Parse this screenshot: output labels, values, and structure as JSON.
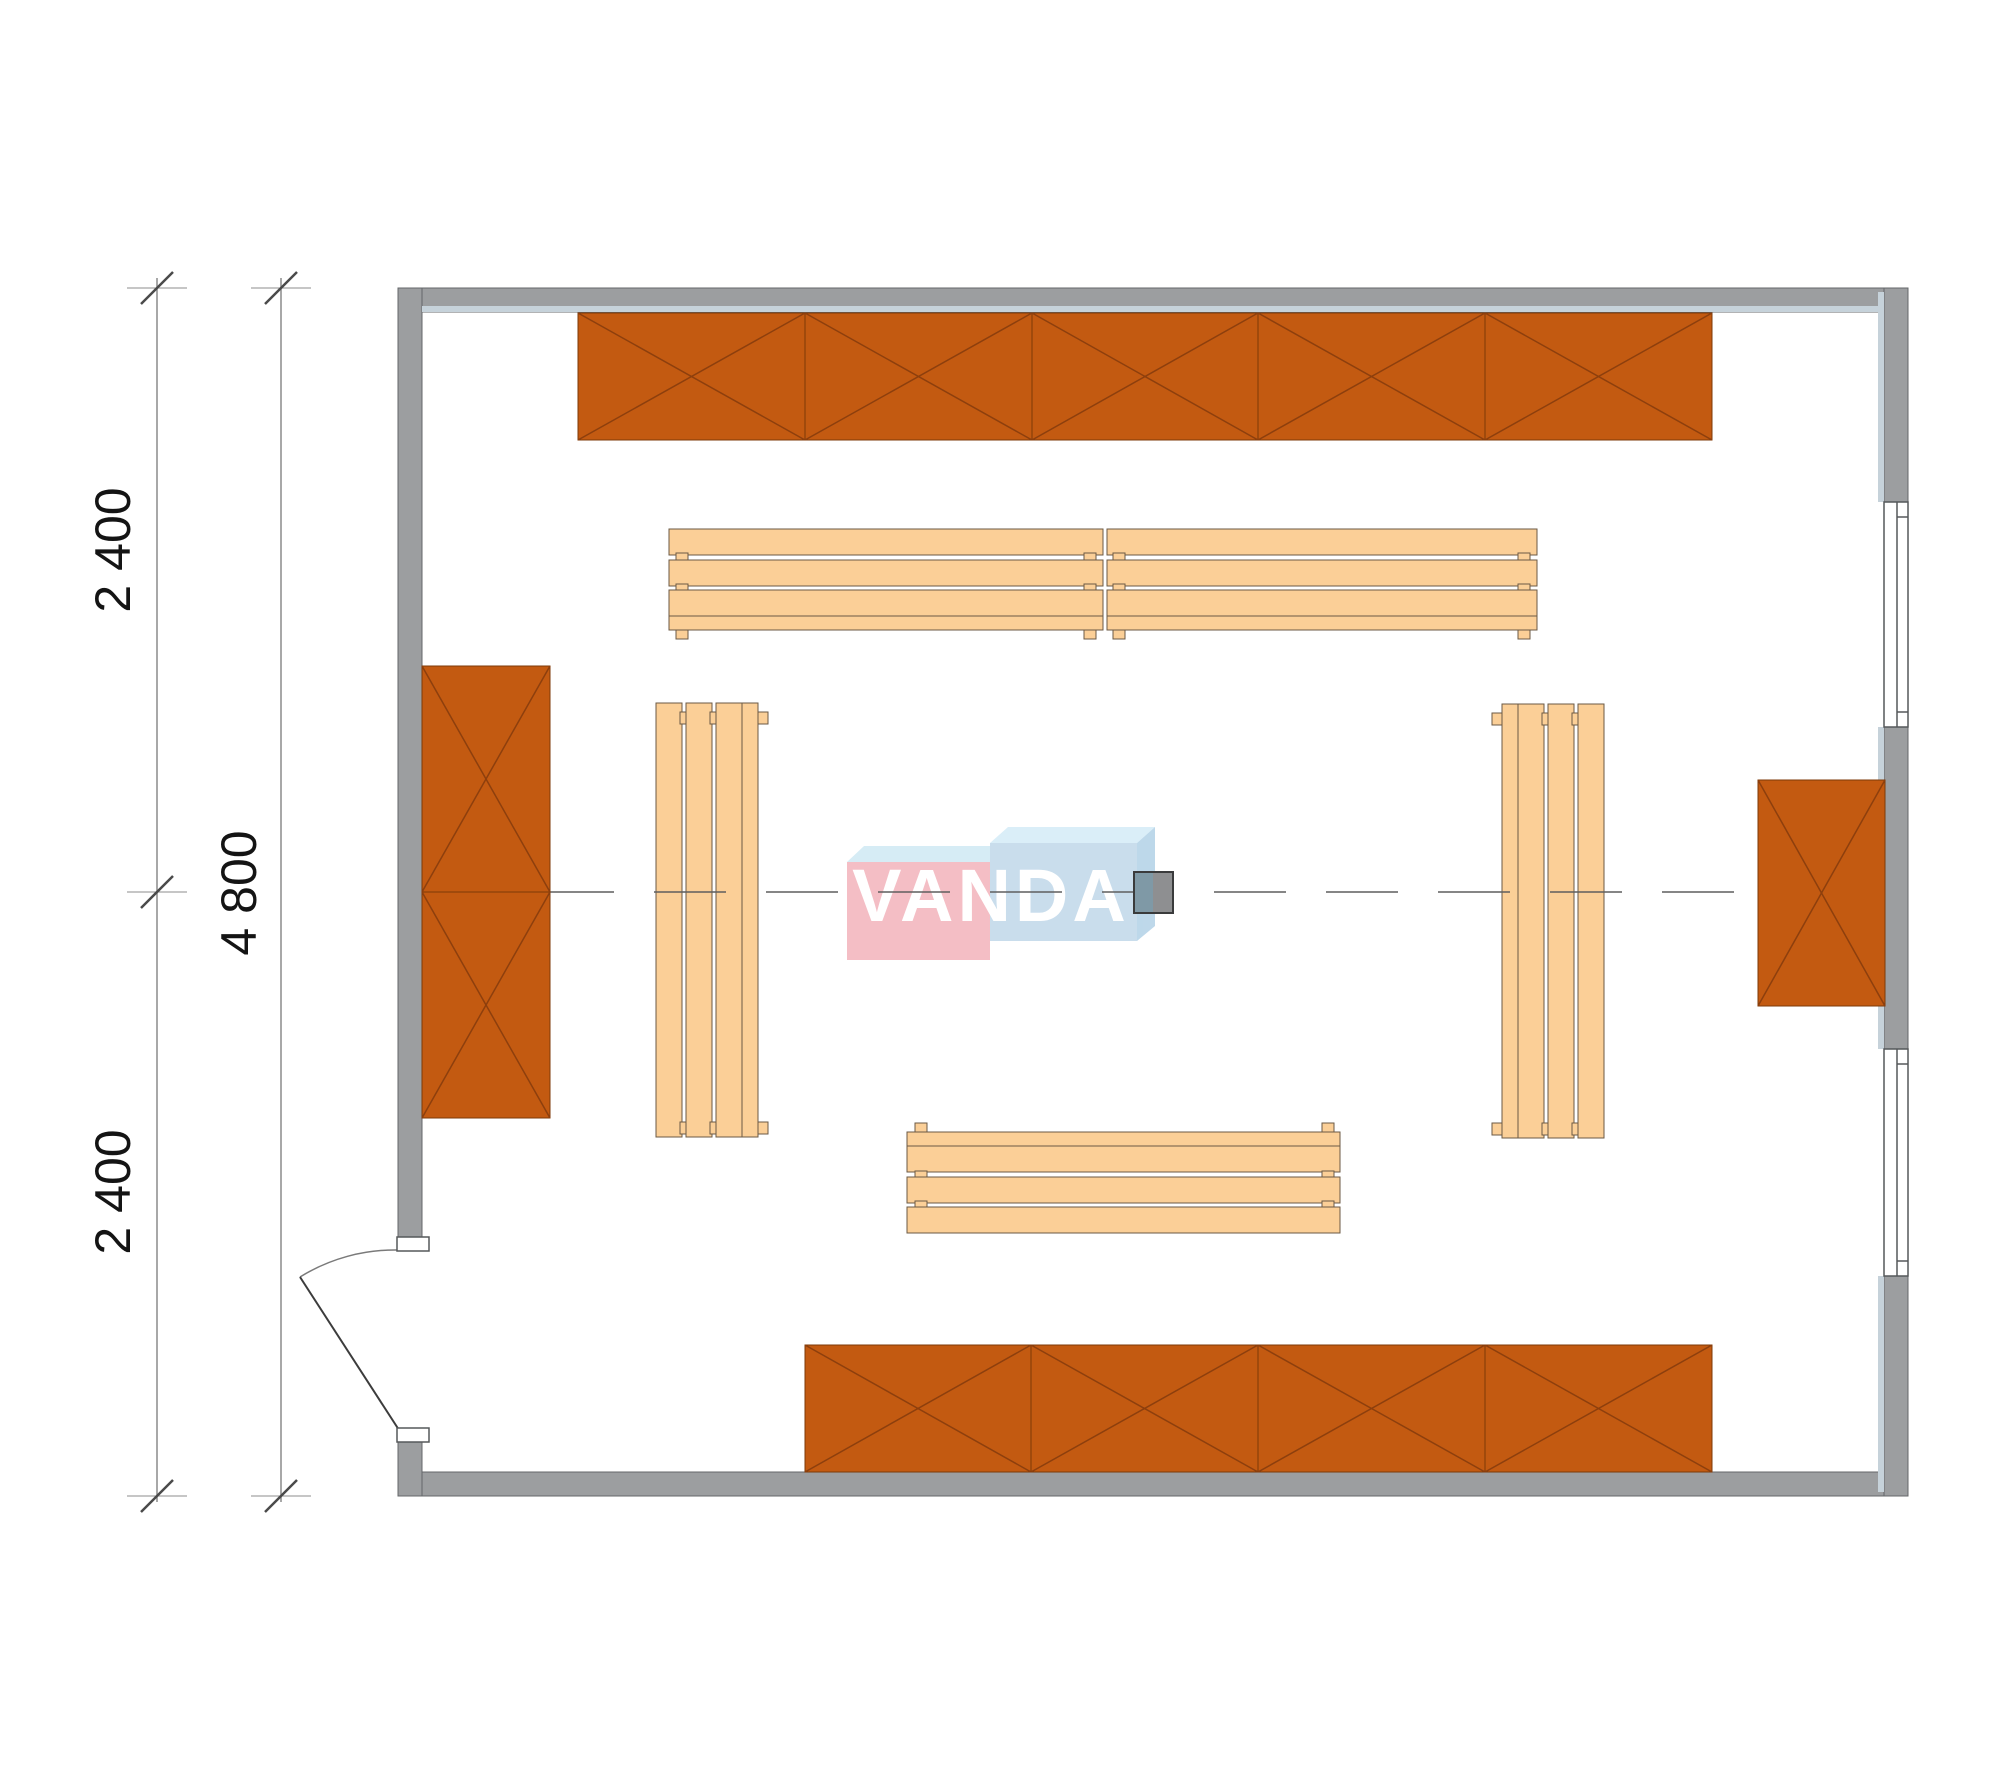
{
  "drawing": {
    "type": "floor-plan",
    "room_exterior_width_mm": 6000,
    "room_exterior_height_mm": 4800
  },
  "dimensions": {
    "vertical_segment_top": "2 400",
    "vertical_total": "4 800",
    "vertical_segment_bottom": "2 400"
  },
  "watermark": {
    "brand": "VANDA"
  },
  "furniture": {
    "wall_cabinet_rows": [
      {
        "location": "top-wall",
        "segments": 5
      },
      {
        "location": "bottom-wall",
        "segments": 4
      },
      {
        "location": "left-wall",
        "segments": 2
      },
      {
        "location": "right-wall",
        "segments": 1
      }
    ],
    "benches": [
      {
        "location": "upper",
        "count": 2,
        "orientation": "horizontal"
      },
      {
        "location": "lower",
        "count": 1,
        "orientation": "horizontal"
      },
      {
        "location": "left-of-center",
        "count": 1,
        "orientation": "vertical"
      },
      {
        "location": "right-of-center",
        "count": 1,
        "orientation": "vertical"
      }
    ],
    "center_block": {
      "halves": [
        "blue-gray",
        "gray"
      ]
    }
  },
  "colors": {
    "wall_fill": "#9c9ea0",
    "wall_edge_highlight": "#c6d2da",
    "cabinet_fill": "#c35a11",
    "cabinet_cross": "#8d3f0d",
    "bench_fill": "#fbcf97",
    "bench_stroke": "#6b5a45",
    "watermark_pink": "#f4bbc2",
    "watermark_blue": "#c7dcec",
    "watermark_top": "#d9eef8",
    "center_block_left": "#7f99a6",
    "center_block_right": "#8e8f91",
    "dimension_line": "#8c8c8c",
    "text": "#141414"
  }
}
